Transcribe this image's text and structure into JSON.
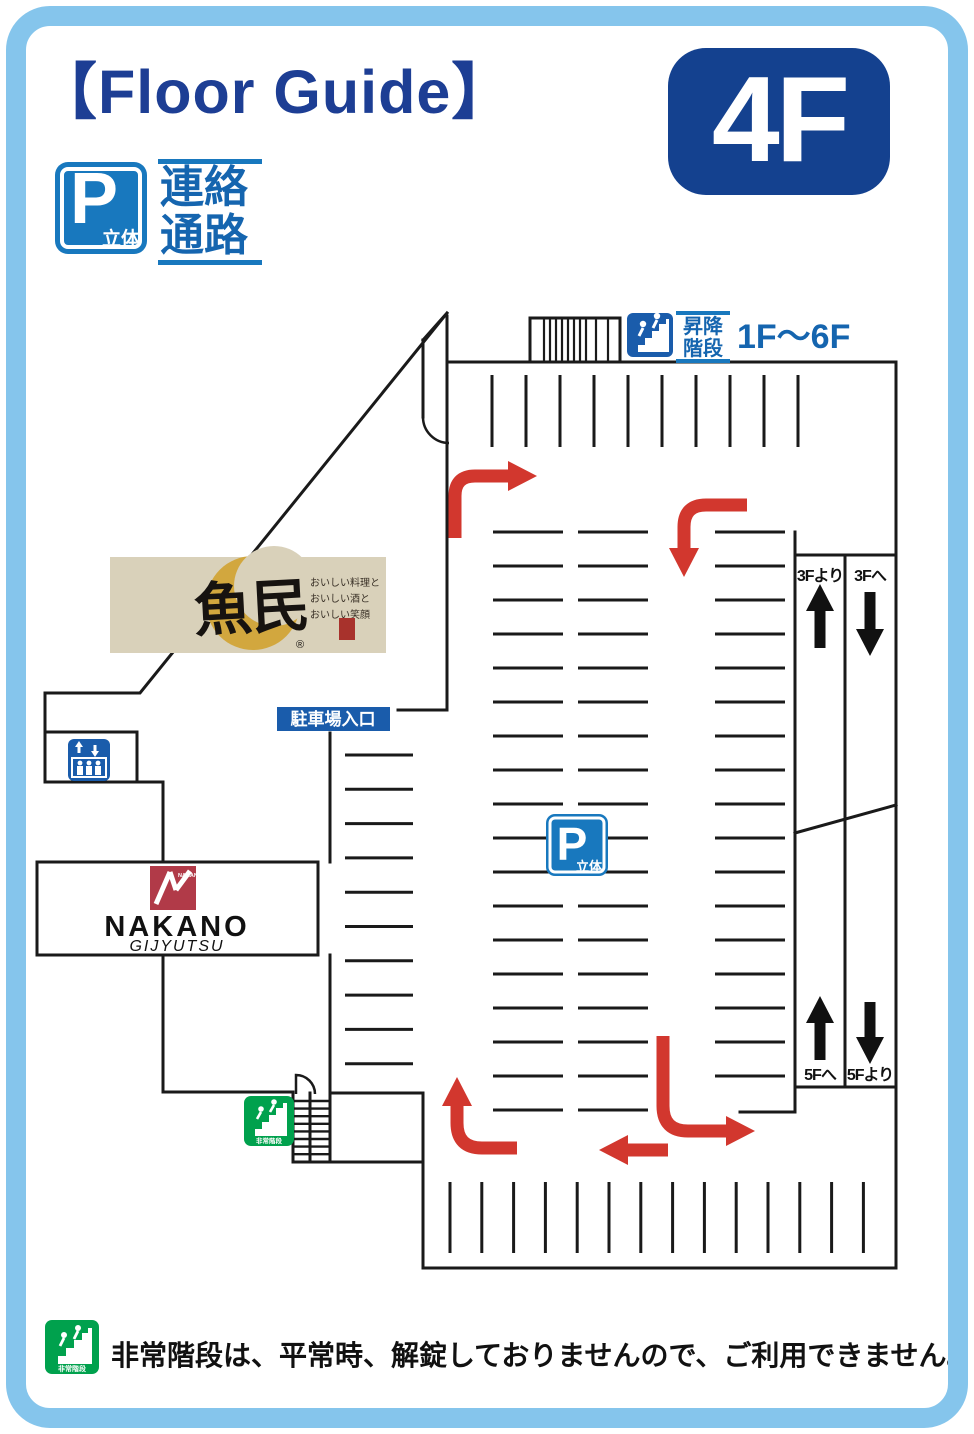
{
  "header": {
    "title": "【Floor Guide】",
    "floor_badge": "4F",
    "parking_badge": {
      "letter": "P",
      "sub": "立体"
    },
    "corridor_label": {
      "line1": "連絡",
      "line2": "通路"
    }
  },
  "map": {
    "stairs_sign": {
      "label_line1": "昇降",
      "label_line2": "階段",
      "range": "1F〜6F"
    },
    "entrance_label": "駐車場入口",
    "center_parking_badge": {
      "letter": "P",
      "sub": "立体"
    },
    "ramp_labels": {
      "from_3f": "3Fより",
      "to_3f": "3Fへ",
      "to_5f": "5Fへ",
      "from_5f": "5Fより"
    },
    "tenants": {
      "uotami": {
        "name": "魚民",
        "tagline_line1": "おいしい料理と",
        "tagline_line2": "おいしい酒と",
        "tagline_line3": "おいしい笑顔",
        "registered_mark": "®"
      },
      "nakano": {
        "logo_text": "NAKANO",
        "name": "NAKANO",
        "sub": "GIJYUTSU"
      }
    }
  },
  "icons": {
    "emergency_label": "非常階段"
  },
  "footer": {
    "note": "非常階段は、平常時、解錠しておりませんので、ご利用できません。"
  },
  "colors": {
    "frame_blue": "#85c5ec",
    "headline_blue": "#1d3e94",
    "badge_blue": "#14418f",
    "parking_sign_blue": "#1878be",
    "label_blue": "#1565af",
    "deep_blue": "#1a5cab",
    "arrow_red": "#d2372e",
    "emergency_green": "#00a14d",
    "nakano_red": "#b13a48",
    "uotami_gold": "#d2a73e",
    "uotami_paper": "#d9d1ba",
    "line_black": "#1a1a1a"
  }
}
